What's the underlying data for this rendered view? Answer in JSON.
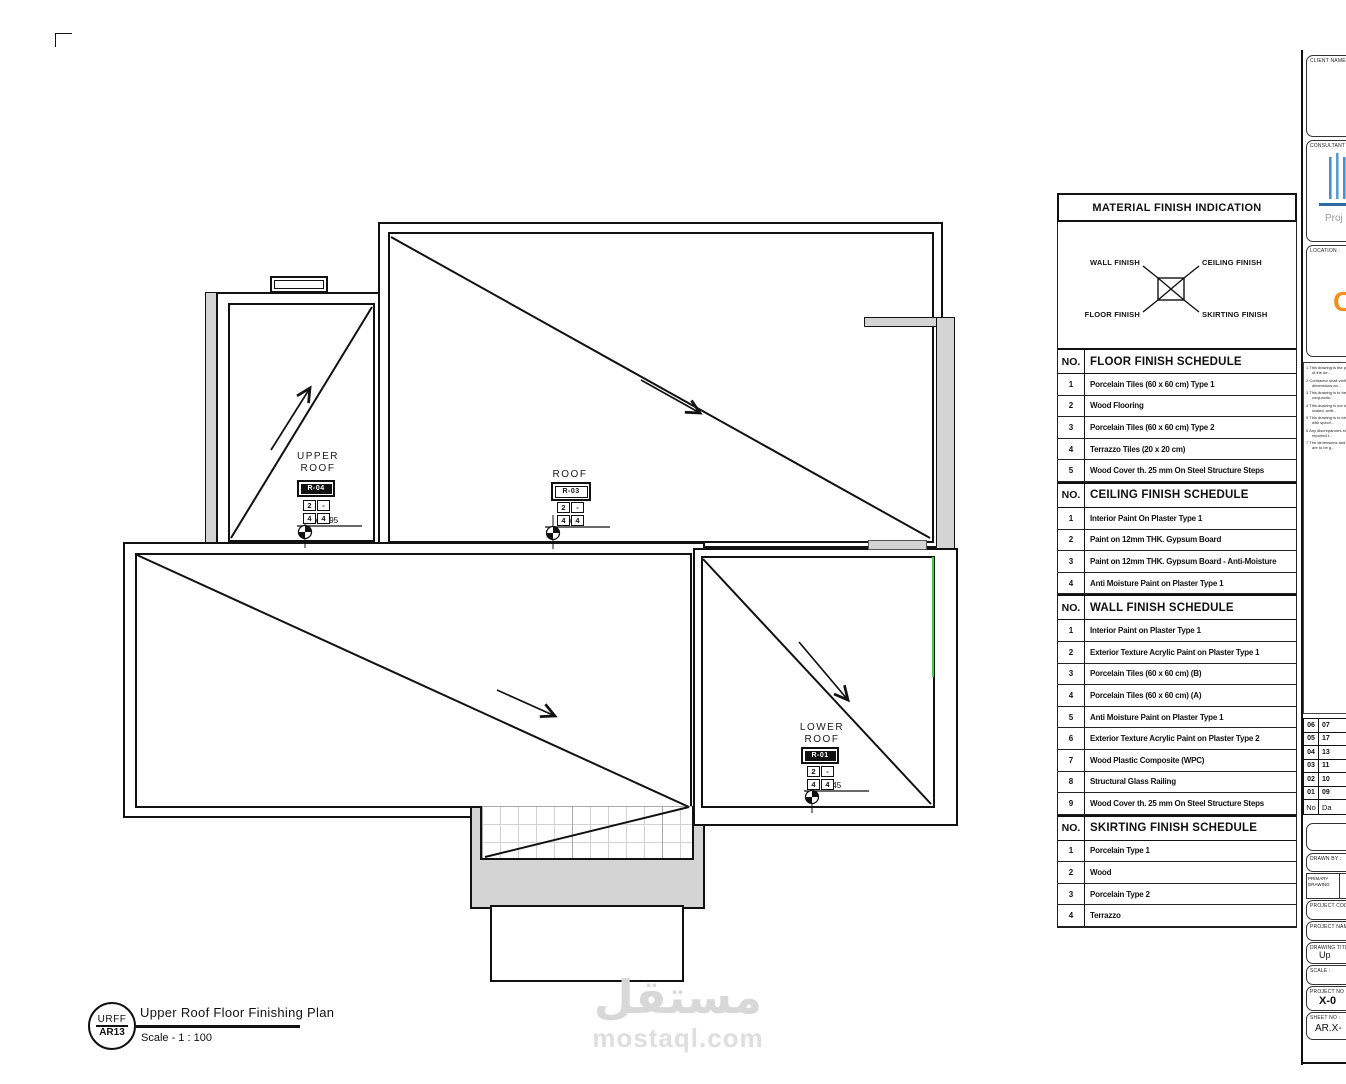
{
  "sheet": {
    "corner_mark": "corner-registration-mark"
  },
  "plan": {
    "areas": [
      {
        "label": "UPPER\nROOF",
        "tag": "R-04",
        "inverted": true,
        "level": "+11.95",
        "finish": {
          "tl": "2",
          "tr": "-",
          "bl": "4",
          "br": "4"
        }
      },
      {
        "label": "ROOF",
        "tag": "R-03",
        "inverted": false,
        "level": "+9.45",
        "finish": {
          "tl": "2",
          "tr": "-",
          "bl": "4",
          "br": "4"
        }
      },
      {
        "label": "LOWER\nROOF",
        "tag": "R-01",
        "inverted": true,
        "level": "+6.45",
        "finish": {
          "tl": "2",
          "tr": "-",
          "bl": "4",
          "br": "4"
        }
      }
    ]
  },
  "panel": {
    "title": "MATERIAL FINISH INDICATION",
    "legend": {
      "wall": "WALL FINISH",
      "ceiling": "CEILING FINISH",
      "floor": "FLOOR FINISH",
      "skirting": "SKIRTING FINISH"
    },
    "schedules": [
      {
        "no_label": "NO.",
        "title": "FLOOR FINISH SCHEDULE",
        "rows": [
          {
            "no": "1",
            "text": "Porcelain Tiles (60 x 60 cm) Type 1"
          },
          {
            "no": "2",
            "text": "Wood Flooring"
          },
          {
            "no": "3",
            "text": "Porcelain Tiles (60 x 60 cm) Type 2"
          },
          {
            "no": "4",
            "text": "Terrazzo Tiles (20 x 20 cm)"
          },
          {
            "no": "5",
            "text": "Wood Cover th. 25 mm On Steel Structure Steps"
          }
        ]
      },
      {
        "no_label": "NO.",
        "title": "CEILING FINISH SCHEDULE",
        "rows": [
          {
            "no": "1",
            "text": "Interior Paint On Plaster Type 1"
          },
          {
            "no": "2",
            "text": "Paint on 12mm THK. Gypsum Board"
          },
          {
            "no": "3",
            "text": "Paint on 12mm THK. Gypsum Board - Anti-Moisture"
          },
          {
            "no": "4",
            "text": "Anti Moisture Paint on Plaster Type 1"
          }
        ]
      },
      {
        "no_label": "NO.",
        "title": "WALL FINISH SCHEDULE",
        "rows": [
          {
            "no": "1",
            "text": "Interior Paint on Plaster Type 1"
          },
          {
            "no": "2",
            "text": "Exterior Texture Acrylic Paint on Plaster Type 1"
          },
          {
            "no": "3",
            "text": "Porcelain Tiles (60 x 60 cm) (B)"
          },
          {
            "no": "4",
            "text": "Porcelain Tiles (60 x 60 cm) (A)"
          },
          {
            "no": "5",
            "text": "Anti Moisture Paint on Plaster Type 1"
          },
          {
            "no": "6",
            "text": "Exterior Texture Acrylic Paint on Plaster Type 2"
          },
          {
            "no": "7",
            "text": "Wood Plastic Composite (WPC)"
          },
          {
            "no": "8",
            "text": "Structural Glass Railing"
          },
          {
            "no": "9",
            "text": "Wood Cover th. 25 mm On Steel Structure Steps"
          }
        ]
      },
      {
        "no_label": "NO.",
        "title": "SKIRTING FINISH SCHEDULE",
        "rows": [
          {
            "no": "1",
            "text": "Porcelain Type 1"
          },
          {
            "no": "2",
            "text": "Wood"
          },
          {
            "no": "3",
            "text": "Porcelain Type 2"
          },
          {
            "no": "4",
            "text": "Terrazzo"
          }
        ]
      }
    ]
  },
  "title_block": {
    "circle_top": "URFF",
    "circle_bottom": "AR13",
    "title": "Upper Roof Floor Finishing Plan",
    "scale": "Scale -  1 : 100"
  },
  "right_strip": {
    "client_label": "CLIENT NAME :",
    "consultant_label": "CONSULTANT :",
    "consultant_sub": "Proj",
    "location_label": "LOCATION :",
    "location_glyph": "C",
    "notes": [
      "This drawing is the property of the de...",
      "Contractor shall verify all dimensions an...",
      "This drawing is to be read in conjunctio...",
      "This drawing is not to be scaled, writt...",
      "This drawing is to be read with specif...",
      "Any discrepancies shall be reported t...",
      "The dimensions and levels are to be g..."
    ],
    "revisions": {
      "rows": [
        {
          "no": "06",
          "date": "07"
        },
        {
          "no": "05",
          "date": "17"
        },
        {
          "no": "04",
          "date": "13"
        },
        {
          "no": "03",
          "date": "11"
        },
        {
          "no": "02",
          "date": "10"
        },
        {
          "no": "01",
          "date": "09"
        }
      ],
      "footer": {
        "no": "No",
        "date": "Da"
      }
    },
    "drawn_by_label": "DRAWN BY :",
    "primary_drawing_label": "PRIMARY DRAWING",
    "project_code_label": "PROJECT CODE :",
    "project_name_label": "PROJECT NAME :",
    "drawing_title_label": "DRAWING TITLE :",
    "drawing_title_value": "Up",
    "scale_label": "SCALE :",
    "project_no_label": "PROJECT NO :",
    "project_no_value": "X-0",
    "sheet_no_label": "SHEET NO :",
    "sheet_no_value": "AR.X-"
  },
  "watermark": {
    "arabic": "مستقل",
    "latin": "mostaql.com"
  },
  "colors": {
    "line": "#111111",
    "grey_fill": "#d4d4d4",
    "grid_minor": "#d2d2d2",
    "grid_major": "#a8a8a8",
    "green_line": "#3fd03f",
    "logo_blue": "#4a90c4",
    "logo_orange": "#ef8f1c",
    "watermark_grey": "#d8d8d8"
  }
}
